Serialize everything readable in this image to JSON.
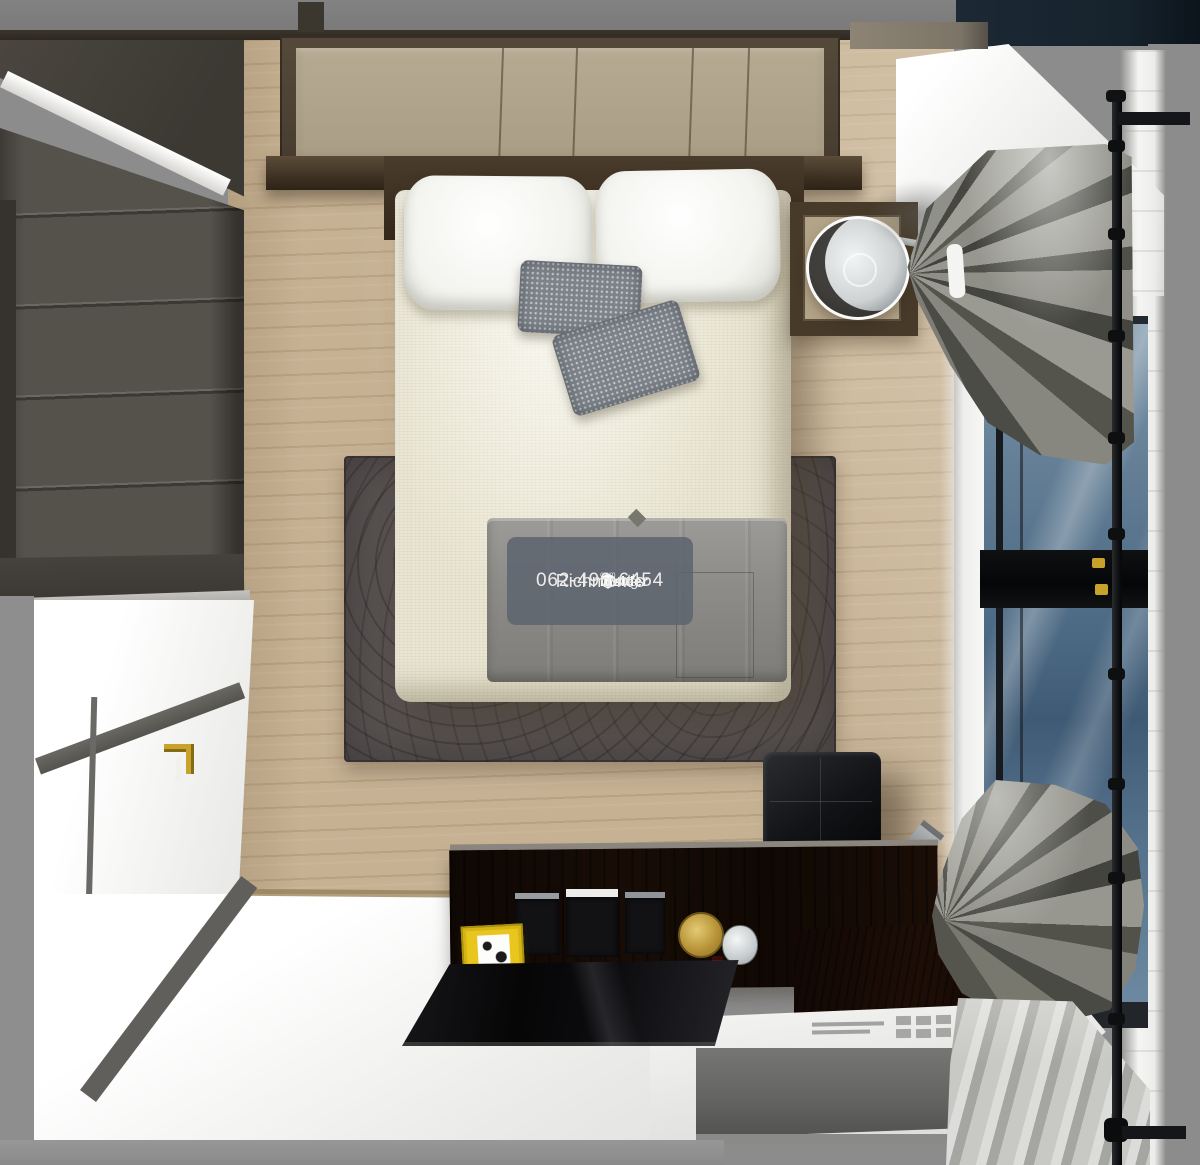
{
  "watermark": {
    "brand": {
      "word1": "Living",
      "word2": "Insider",
      "tld": "com"
    },
    "agent_name": "Richmont's",
    "phone": "062-496-6454"
  },
  "scene": {
    "view": "top-down 3d interior render",
    "room": "bedroom",
    "objects": [
      "wardrobe",
      "white-door",
      "double-bed",
      "white-pillows",
      "gray-throw-pillows",
      "gray-blanket",
      "area-rug",
      "nightstand",
      "glass-table-lamp",
      "headboard-panel-wall",
      "window",
      "bunched-curtains",
      "curtain-rod",
      "black-leather-ottoman",
      "vanity-desk",
      "black-glass-desktop",
      "white-cabinet-with-vents",
      "yellow-photo-frame",
      "gold-mirror",
      "glass-jar",
      "perfume-bottle",
      "wood-floor",
      "white-floor"
    ]
  },
  "colors": {
    "outside_gray": "#8c8c8c",
    "navy_top": "#18232d",
    "wood_floor": "#c6b193",
    "headboard_panel": "#b6aa92",
    "wardrobe_body": "#55514b",
    "duvet": "#eae6d3",
    "throw_pillow": "#7d838a",
    "blanket_gray": "#8d8c88",
    "rug": "#575150",
    "nightstand_wood": "#473a29",
    "nightstand_inner": "#b4a487",
    "curtain_base": "#92928a",
    "curtain_fold": "#4c4c46",
    "window_glass_top": "#8099ac",
    "window_glass_bottom": "#3f5a74",
    "ottoman_black": "#121316",
    "desk_wenge": "#32241a",
    "desk_glass": "#060607",
    "drawer_gray": "#646463",
    "gold_accent": "#c9a22b",
    "yellow_frame": "#e8c61d",
    "red_accent": "#8c1d12",
    "watermark_bg": "rgba(92,100,110,0.85)",
    "watermark_text": "#f2f2f0"
  }
}
